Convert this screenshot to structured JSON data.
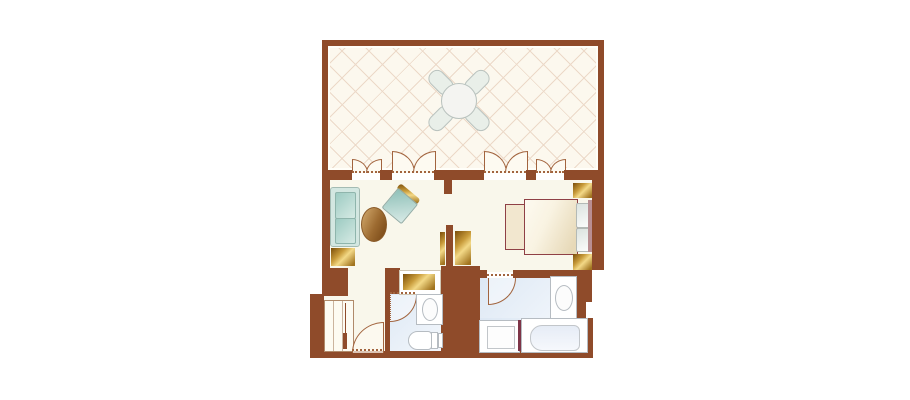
{
  "meta": {
    "type": "floor-plan",
    "description": "Guest room floor plan: balcony with patio set, living area, bedroom, entry closet, powder room and bathroom",
    "text_labels": []
  },
  "palette": {
    "wall": "#8F4B2A",
    "door-arc": "#A2643E",
    "floor": "#F9F7EB",
    "balcony-floor": "#FCF8EE",
    "tile-line": "#ECD9C8",
    "bath-floor-a": "#DDE8F4",
    "bath-floor-b": "#F3F7FC",
    "gold-dark": "#7A4D0A",
    "gold-mid": "#C89B3A",
    "gold-light": "#F3D987",
    "teal-dark": "#9DCBC2",
    "teal-light": "#D6EAE4",
    "bed-edge": "#8F4045",
    "fixture-border": "#B6BCC2",
    "cream-door": "#FDFAF1",
    "tub-divider": "#7E3548",
    "headboard": "#B98F92"
  },
  "rooms": {
    "balcony": {
      "furniture": [
        "patio-table",
        "patio-chair x4"
      ],
      "floor": "diagonal-tile"
    },
    "living-area": {
      "furniture": [
        "sofa",
        "coffee-table",
        "armchair",
        "side-cabinet",
        "tv-stand"
      ]
    },
    "bedroom": {
      "furniture": [
        "bed",
        "bed-bench",
        "pillow x2",
        "headboard",
        "nightstand x2",
        "media-cabinet"
      ]
    },
    "entry": {
      "furniture": [
        "closet",
        "entry-door"
      ]
    },
    "powder-room": {
      "furniture": [
        "vanity-counter",
        "sink",
        "toilet",
        "door"
      ]
    },
    "bathroom": {
      "furniture": [
        "sink",
        "shower",
        "bathtub",
        "door"
      ]
    }
  },
  "doors": {
    "balcony_french_doors": 4,
    "interior_doors": 3
  }
}
